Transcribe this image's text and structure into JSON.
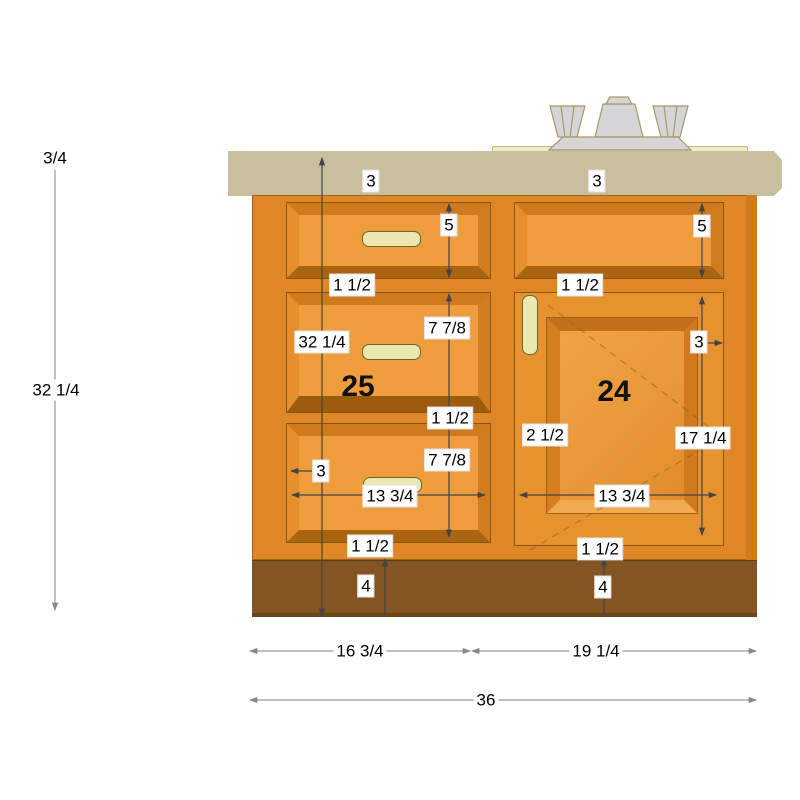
{
  "diagram": {
    "kind": "base cabinet elevation with sink and faucet",
    "left_unit_number": "25",
    "right_unit_number": "24"
  },
  "colors": {
    "countertop": "#c8bf9e",
    "sink_deck": "#f1ecc9",
    "cabinet_face": "#df8626",
    "cabinet_side_edge": "#d07a1c",
    "drawer_face": "#ef9d3c",
    "drawer_bevel_top": "#cf7b1d",
    "drawer_bevel_bottom": "#aa6511",
    "door_face": "#e6932f",
    "door_panel_bevel_bottom": "#f0aa52",
    "toe_kick": "#825522",
    "handle": "#eae7b3",
    "faucet": "#d5d5d7",
    "dimension_line_dark": "#444444",
    "dimension_line_gray": "#999999"
  },
  "dimensions": {
    "countertop_overhang": "3/4",
    "cabinet_height": "32 1/4",
    "countertop_thickness_left": "3",
    "countertop_thickness_right": "3",
    "top_drawer_height": "5",
    "sink_front_height": "5",
    "top_rail_left": "1 1/2",
    "top_rail_right": "1 1/2",
    "middle_drawer_front": "7 7/8",
    "face_height": "32 1/4",
    "mid_rail": "1 1/2",
    "bottom_drawer_front": "7 7/8",
    "door_stile_right": "3",
    "door_stile_left": "2 1/2",
    "door_panel_height": "17 1/4",
    "drawer_side_margin": "3",
    "drawer_handle_span": "13 3/4",
    "door_panel_width": "13 3/4",
    "bottom_rail_left": "1 1/2",
    "bottom_rail_right": "1 1/2",
    "toe_kick_height_left": "4",
    "toe_kick_height_right": "4",
    "drawer_bank_width": "16 3/4",
    "sink_section_width": "19 1/4",
    "total_width": "36"
  }
}
